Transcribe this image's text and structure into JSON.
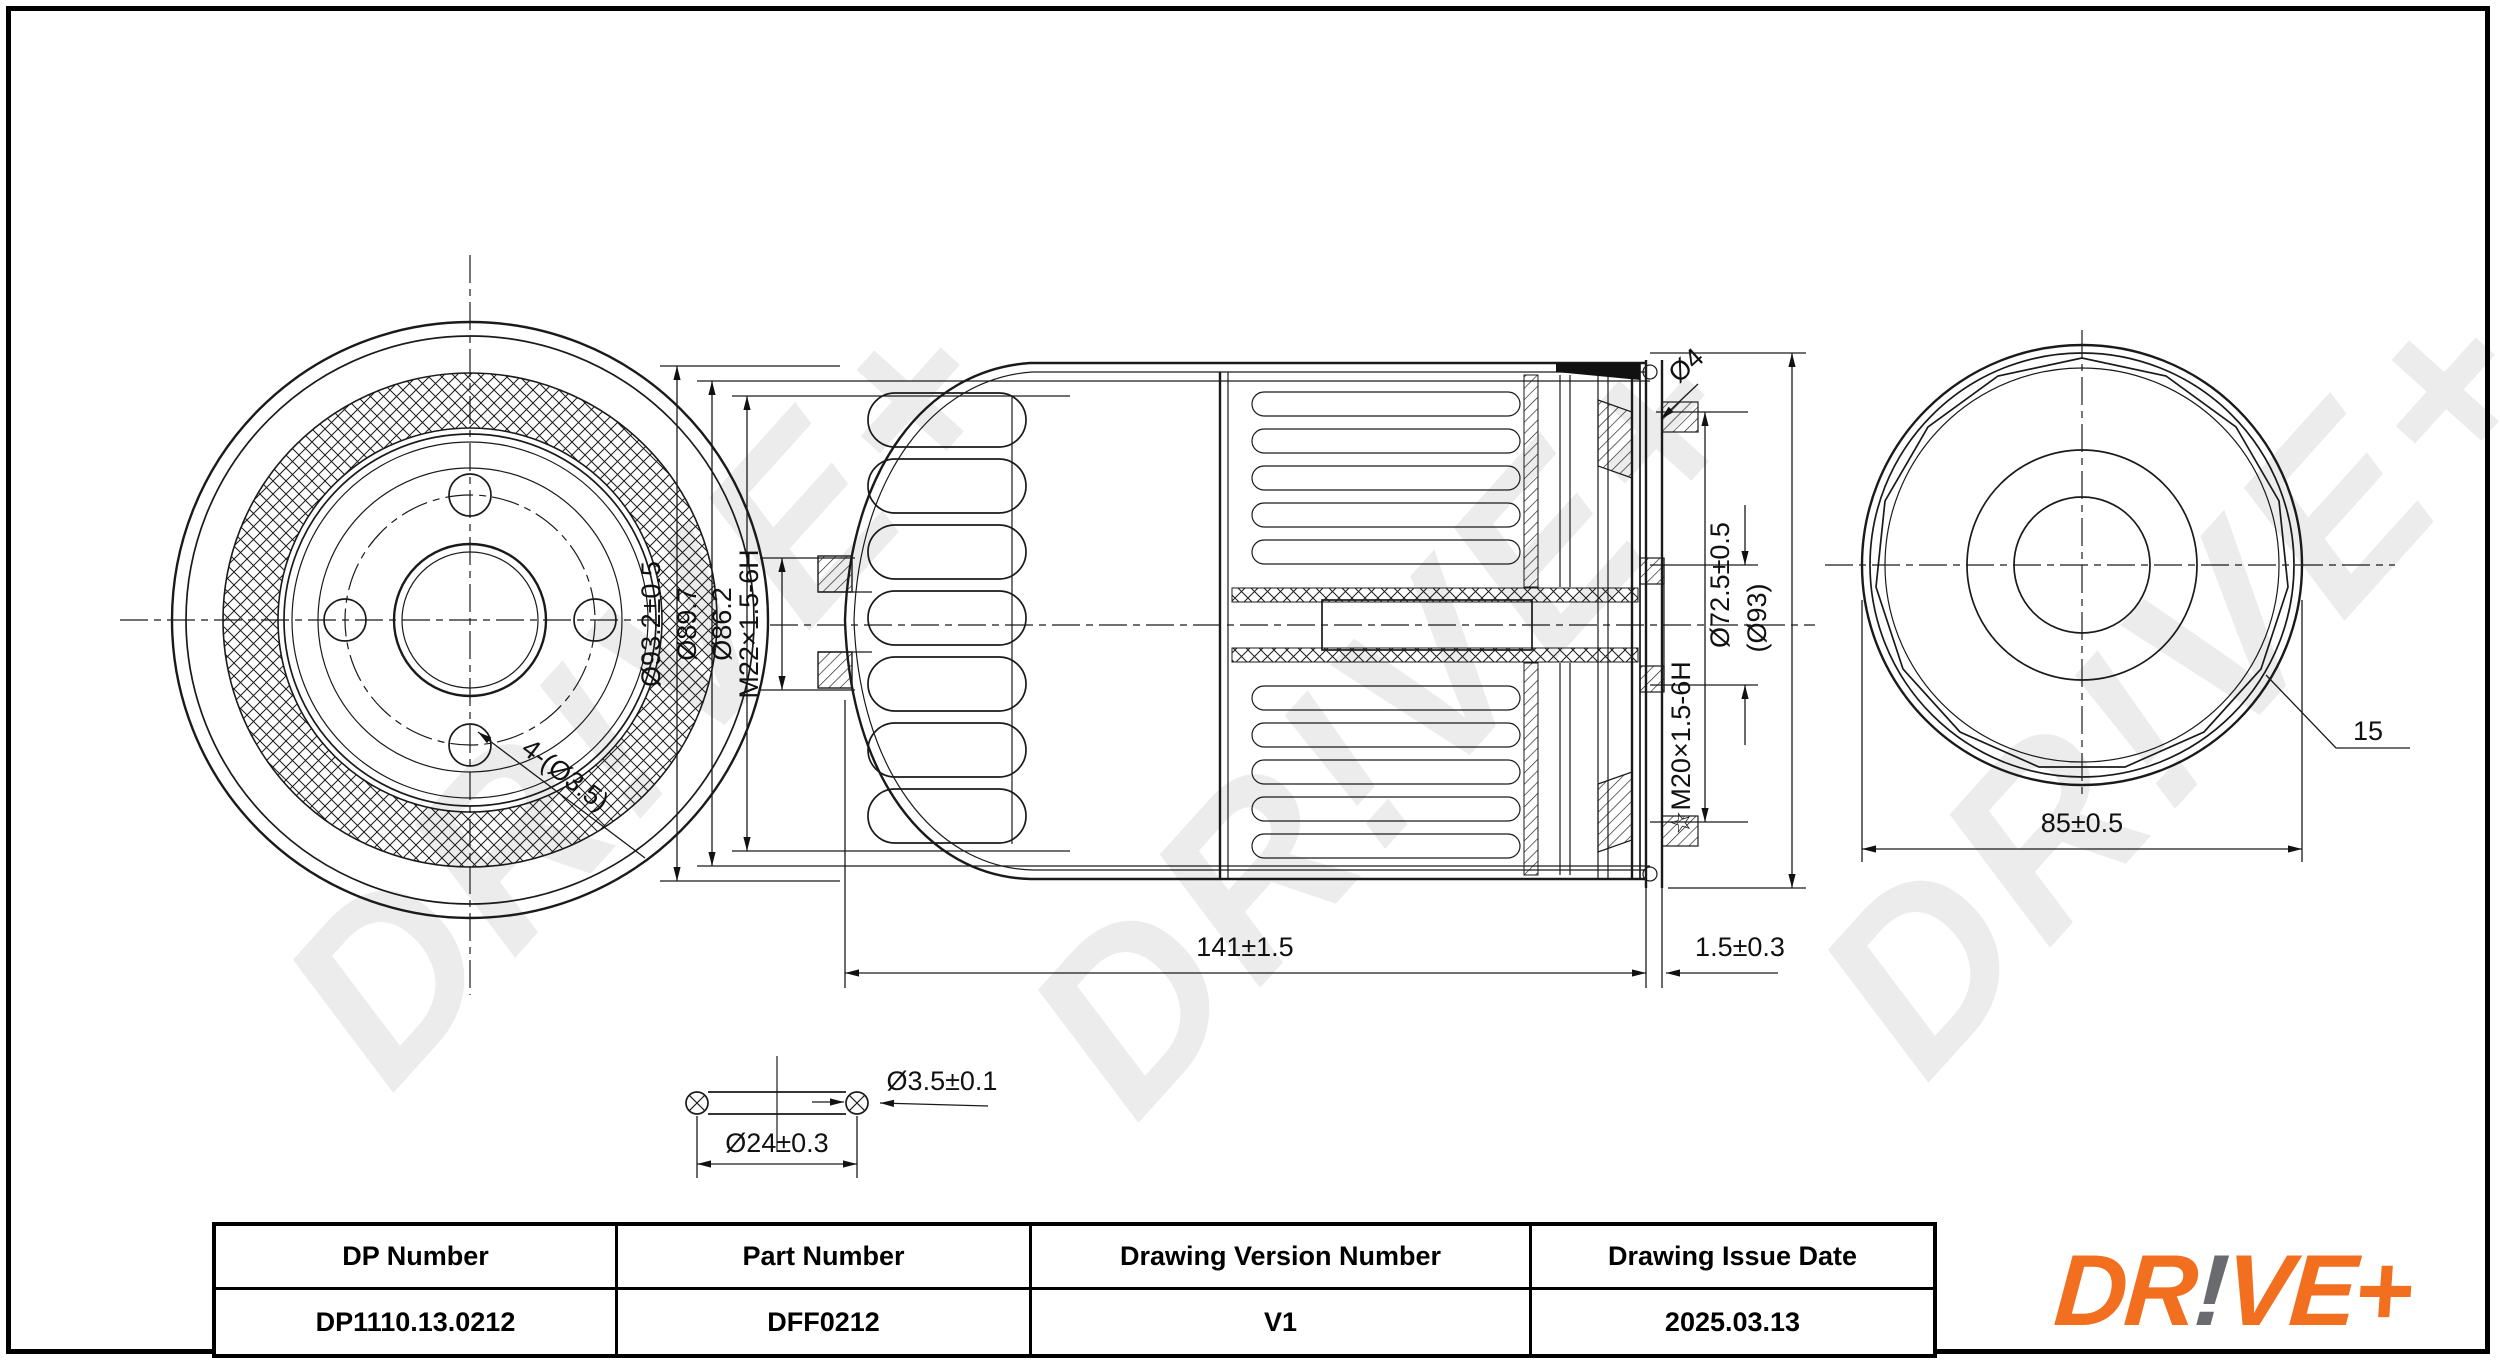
{
  "sheet": {
    "background": "#ffffff",
    "line_color": "#1a1a1a"
  },
  "watermark": {
    "text": "DR!VE+",
    "color": "#ececec"
  },
  "left_view": {
    "holes_label": "4-(Ø3.5)"
  },
  "section_view": {
    "dia_outer": "Ø93.2±0.5",
    "dia_shell": "Ø89.7",
    "dia_body": "Ø86.2",
    "thread_inlet": "M22×1.5-6H",
    "bead_dia": "Ø4",
    "seal_dia": "Ø72.5±0.5",
    "ref_dia": "(Ø93)",
    "thread_outlet": "☆M20×1.5-6H",
    "length": "141±1.5",
    "gasket_thickness": "1.5±0.3"
  },
  "end_view": {
    "flats": "15",
    "across_flats": "85±0.5"
  },
  "oring_detail": {
    "cross_section": "Ø3.5±0.1",
    "inner_dia": "Ø24±0.3"
  },
  "title_block": {
    "columns": [
      {
        "label": "DP Number",
        "value": "DP1110.13.0212"
      },
      {
        "label": "Part Number",
        "value": "DFF0212"
      },
      {
        "label": "Drawing Version Number",
        "value": "V1"
      },
      {
        "label": "Drawing Issue Date",
        "value": "2025.03.13"
      }
    ]
  },
  "logo": {
    "prefix": "DR",
    "bang": "!",
    "suffix": "VE+",
    "orange": "#F26F1F",
    "gray": "#6A6B6E"
  }
}
